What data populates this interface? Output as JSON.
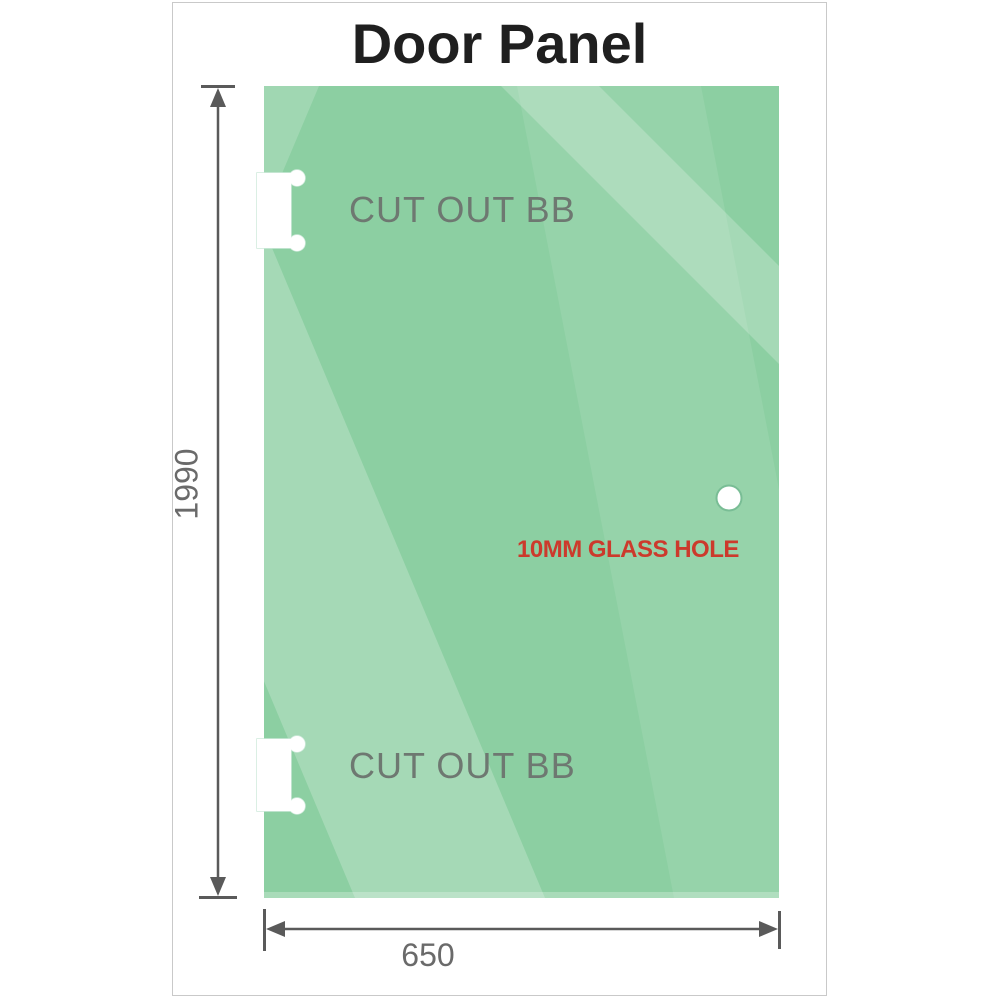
{
  "title": "Door Panel",
  "panel": {
    "cutout_top_label": "CUT OUT BB",
    "cutout_bottom_label": "CUT OUT BB",
    "glass_hole_label": "10MM GLASS HOLE"
  },
  "dimensions": {
    "height": "1990",
    "width": "650"
  },
  "colors": {
    "glass_green": "#8ccfa2",
    "glass_reflection": "#ffffff",
    "cutout_white": "#ffffff",
    "dimension_line_gray": "#5a5a5a",
    "dimension_label_gray": "#6a6a6a",
    "cutout_label_gray": "#6e7871",
    "hole_label_red": "#cc3a2c",
    "title_black": "#1f1f1f",
    "card_border_gray": "#c9c9c9"
  }
}
